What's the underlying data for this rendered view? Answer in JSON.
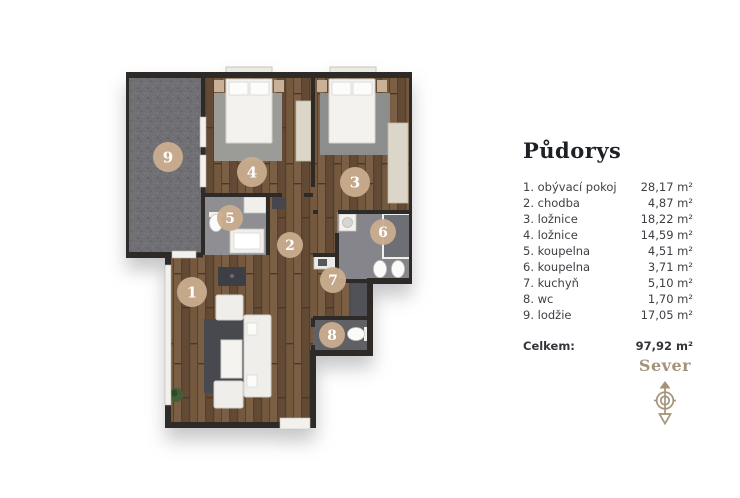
{
  "page": {
    "background": "#ffffff"
  },
  "legend": {
    "title": "Půdorys",
    "rooms": [
      {
        "label": "1. obývací pokoj",
        "area": "28,17 m²"
      },
      {
        "label": "2. chodba",
        "area": "4,87 m²"
      },
      {
        "label": "3. ložnice",
        "area": "18,22 m²"
      },
      {
        "label": "4. ložnice",
        "area": "14,59 m²"
      },
      {
        "label": "5. koupelna",
        "area": "4,51 m²"
      },
      {
        "label": "6. koupelna",
        "area": "3,71 m²"
      },
      {
        "label": "7. kuchyň",
        "area": "5,10 m²"
      },
      {
        "label": "8. wc",
        "area": "1,70 m²"
      },
      {
        "label": "9. lodžie",
        "area": "17,05 m²"
      }
    ],
    "total": {
      "label": "Celkem:",
      "area": "97,92 m²"
    }
  },
  "compass": {
    "label": "Sever",
    "icon": "north-compass-arrow-icon",
    "color": "#a4937a"
  },
  "plan": {
    "badges": [
      {
        "number": "1"
      },
      {
        "number": "2"
      },
      {
        "number": "3"
      },
      {
        "number": "4"
      },
      {
        "number": "5"
      },
      {
        "number": "6"
      },
      {
        "number": "7"
      },
      {
        "number": "8"
      },
      {
        "number": "9"
      }
    ],
    "colors": {
      "wall": "#2d2a28",
      "badge": "#c9ad8e",
      "wood": "#6e543c",
      "loggia_tile": "#707074",
      "bathroom_tile": "#8f8f93",
      "accent": "#a4937a"
    }
  }
}
